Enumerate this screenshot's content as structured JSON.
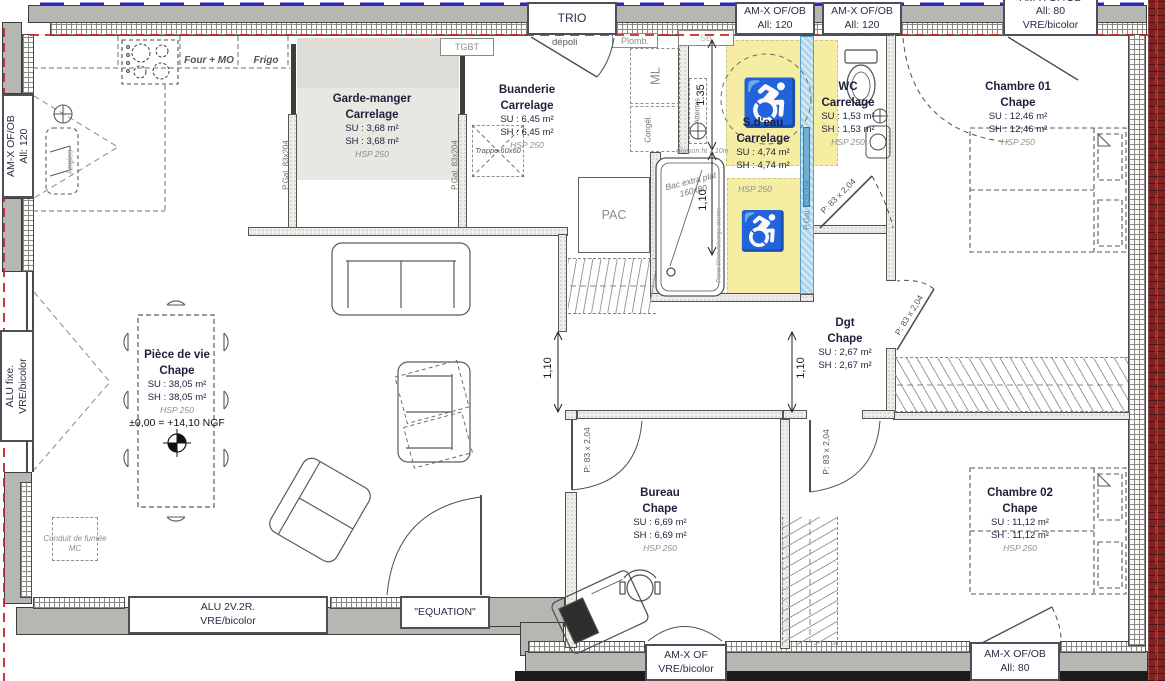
{
  "plan": {
    "rooms": [
      {
        "name": "Pièce de vie",
        "finish": "Chape",
        "su": "SU : 38,05 m²",
        "sh": "SH : 38,05 m²",
        "hsp": "HSP 250",
        "level": "±0,00 = +14,10 NGF"
      },
      {
        "name": "Garde-manger",
        "finish": "Carrelage",
        "su": "SU : 3,68 m²",
        "sh": "SH : 3,68 m²",
        "hsp": "HSP 250"
      },
      {
        "name": "Buanderie",
        "finish": "Carrelage",
        "su": "SU : 6,45 m²",
        "sh": "SH : 6,45 m²",
        "hsp": "HSP 250"
      },
      {
        "name": "S.d'eau",
        "finish": "Carrelage",
        "su": "SU : 4,74 m²",
        "sh": "SH : 4,74 m²",
        "hsp": "HSP 250"
      },
      {
        "name": "WC",
        "finish": "Carrelage",
        "su": "SU : 1,53 m²",
        "sh": "SH : 1,53 m²",
        "hsp": "HSP 250"
      },
      {
        "name": "Chambre 01",
        "finish": "Chape",
        "su": "SU : 12,46 m²",
        "sh": "SH : 12,46 m²",
        "hsp": "HSP 250"
      },
      {
        "name": "Dgt",
        "finish": "Chape",
        "su": "SU : 2,67 m²",
        "sh": "SH : 2,67 m²"
      },
      {
        "name": "Bureau",
        "finish": "Chape",
        "su": "SU : 6,69 m²",
        "sh": "SH : 6,69 m²",
        "hsp": "HSP 250"
      },
      {
        "name": "Chambre 02",
        "finish": "Chape",
        "su": "SU : 11,12 m²",
        "sh": "SH : 11,12 m²",
        "hsp": "HSP 250"
      }
    ],
    "openings": {
      "trio": "TRIO",
      "depoli": "dépoli",
      "amx_ofob": "AM-X OF/OB",
      "amx_of": "AM-X OF",
      "all_120": "All: 120",
      "all_80": "All: 80",
      "vre": "VRE/bicolor",
      "alu_fixe": "ALU fixe.",
      "alu_2v2r": "ALU 2V.2R.",
      "equation": "\"EQUATION\""
    },
    "doors": {
      "pgal": "P.Gal. 83x204",
      "p83": "P: 83 x 2,04"
    },
    "dims": {
      "d135": "1.35",
      "d110": "1,10"
    },
    "annotations": {
      "tgbt": "TGBT",
      "plomb": "Plomb.",
      "sb": "SB",
      "ml": "ML",
      "congel": "Congél.",
      "attentes": "Attentes",
      "pac": "PAC",
      "four_mo": "Four + MO",
      "frigo": "Frigo",
      "trappe": "Trappe 60x60",
      "bac_l1": "Bac extra plat",
      "bac_l2": "160x80",
      "conduit_l1": "Conduit de fumée",
      "conduit_l2": "MC",
      "angles": "Angles",
      "cloison": "Cloison ht 1,10m",
      "paroi": "Paroi 90cm/charge cliente"
    },
    "icons": {
      "wheelchair": "♿"
    },
    "colors": {
      "accessible_zone": "#f4eda2",
      "pocket_door": "#aed5ea",
      "envelope_line": "#cc2020",
      "boundary_line": "#2b2bb5",
      "brick": "#7d2424",
      "wall_grey": "#b6b6b3"
    }
  }
}
